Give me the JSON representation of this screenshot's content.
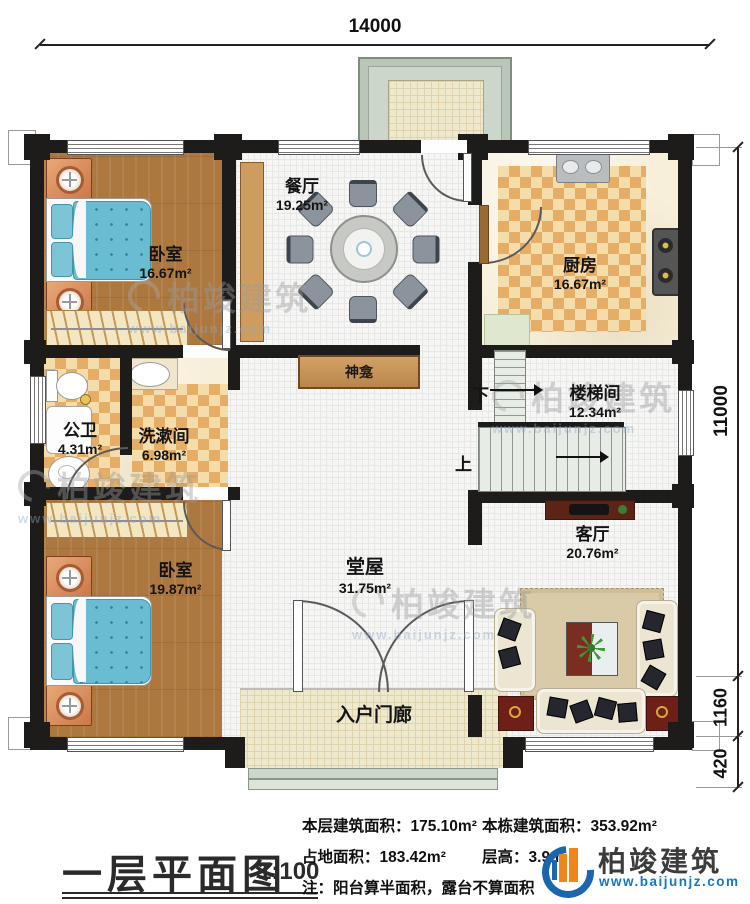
{
  "dimensions": {
    "top": "14000",
    "right_main": "11000",
    "right_porch": "1160",
    "right_steps": "420"
  },
  "rooms": {
    "bedroom1": {
      "name": "卧室",
      "area": "16.67m²"
    },
    "dining": {
      "name": "餐厅",
      "area": "19.25m²"
    },
    "kitchen": {
      "name": "厨房",
      "area": "16.67m²"
    },
    "bathroom": {
      "name": "公卫",
      "area": "4.31m²"
    },
    "washroom": {
      "name": "洗漱间",
      "area": "6.98m²"
    },
    "shrine": {
      "name": "神龛"
    },
    "stairwell": {
      "name": "楼梯间",
      "area": "12.34m²"
    },
    "bedroom2": {
      "name": "卧室",
      "area": "19.87m²"
    },
    "hall": {
      "name": "堂屋",
      "area": "31.75m²"
    },
    "living": {
      "name": "客厅",
      "area": "20.76m²"
    },
    "porch": {
      "name": "入户门廊"
    }
  },
  "stairs": {
    "up": "上",
    "down": "下"
  },
  "footer": {
    "title": "一层平面图",
    "scale": "1:100",
    "stats": [
      {
        "label": "本层建筑面积：",
        "value": "175.10m²"
      },
      {
        "label": "本栋建筑面积：",
        "value": "353.92m²"
      },
      {
        "label": "占地面积：",
        "value": "183.42m²"
      },
      {
        "label": "层高：",
        "value": "3.9m"
      }
    ],
    "note": "注：阳台算半面积，露台不算面积"
  },
  "logo": {
    "name": "柏竣建筑",
    "url": "www.baijunjz.com"
  },
  "watermark": {
    "text": "柏竣建筑",
    "url": "www.baijunjz.com"
  },
  "colors": {
    "wall": "#1d1c1a",
    "wood": "#ad7840",
    "checker_light": "#f5dcab",
    "checker_dark": "#e5ad66",
    "bed_blue": "#69bcd2",
    "stair_tread": "#e8ece6",
    "logo_blue": "#1b66ad",
    "logo_orange": "#f08519",
    "url_blue": "#1578be"
  }
}
